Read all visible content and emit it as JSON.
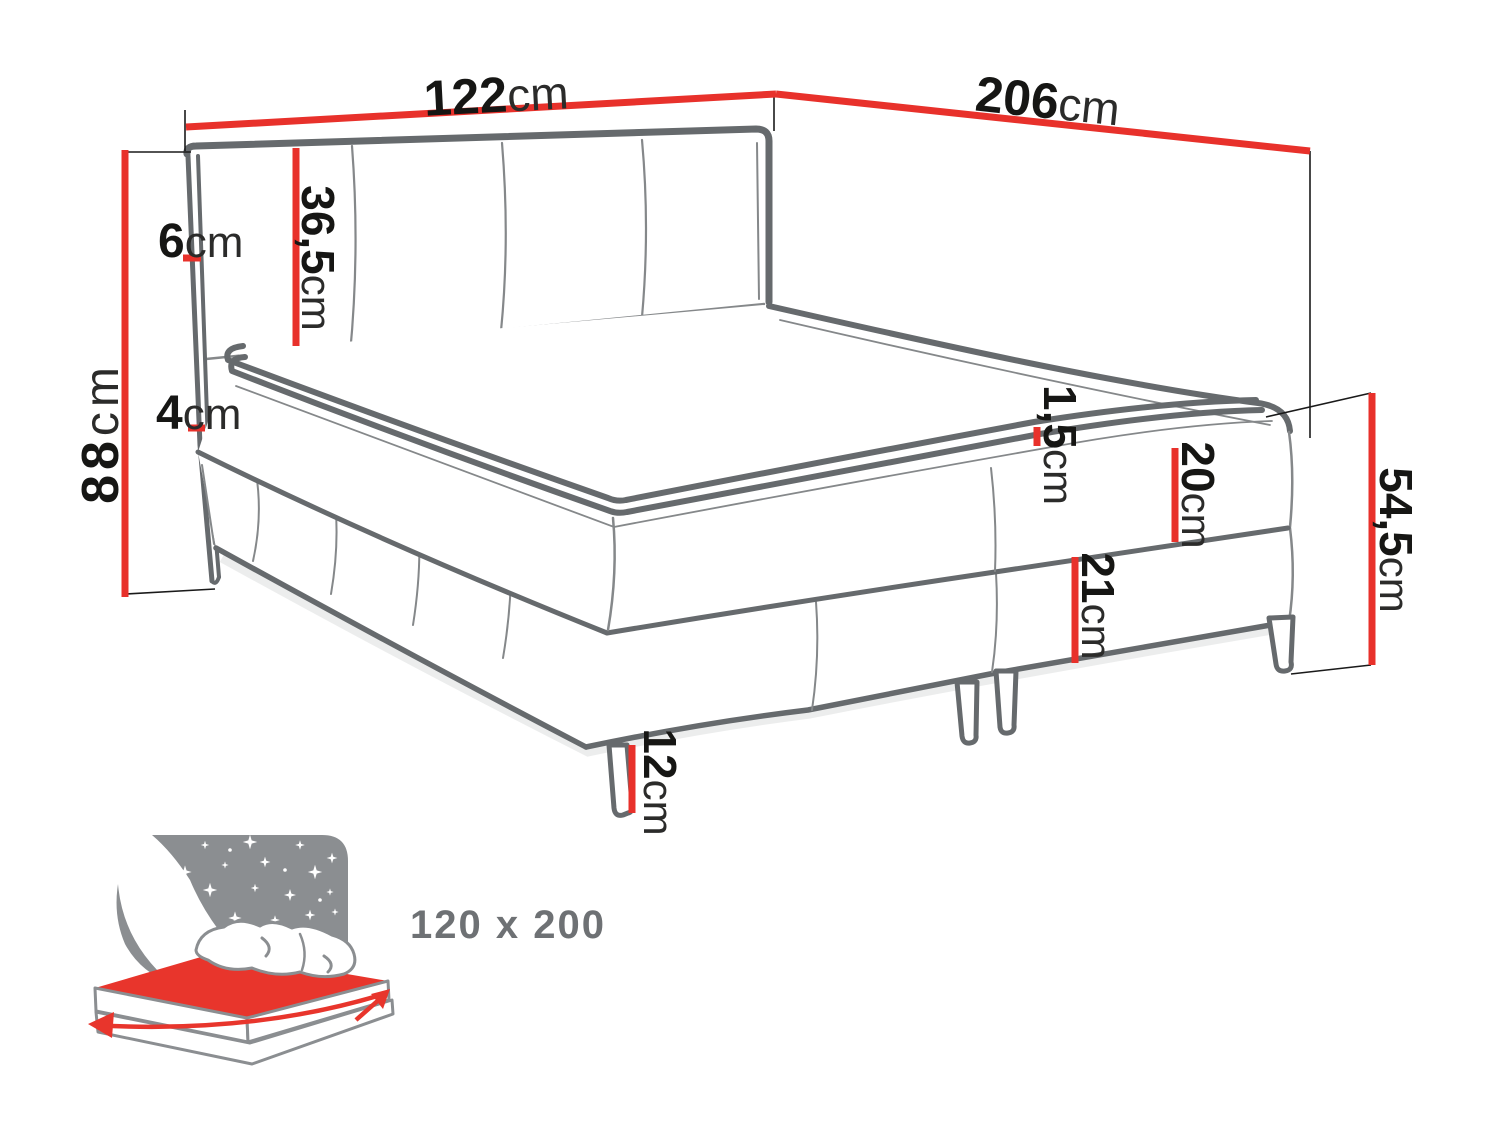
{
  "diagram": {
    "dims": {
      "width": {
        "value": "122",
        "unit": "cm"
      },
      "length": {
        "value": "206",
        "unit": "cm"
      },
      "total_height": {
        "value": "88",
        "unit": "cm"
      },
      "headboard_panel_height": {
        "value": "36,5",
        "unit": "cm"
      },
      "frame_width_top": {
        "value": "6",
        "unit": "cm"
      },
      "frame_width_bottom": {
        "value": "4",
        "unit": "cm"
      },
      "topper_seam": {
        "value": "1,5",
        "unit": "cm"
      },
      "mattress_height": {
        "value": "20",
        "unit": "cm"
      },
      "base_height": {
        "value": "21",
        "unit": "cm"
      },
      "side_height": {
        "value": "54,5",
        "unit": "cm"
      },
      "leg_height": {
        "value": "12",
        "unit": "cm"
      }
    },
    "size_label": "120 x 200",
    "colors": {
      "dimension": "#e8312b",
      "bed_outline": "#666a6d",
      "seam": "#85888a",
      "label": "#1a1a19",
      "icon_gray": "#8b8e91",
      "size_text": "#6e7174"
    }
  }
}
